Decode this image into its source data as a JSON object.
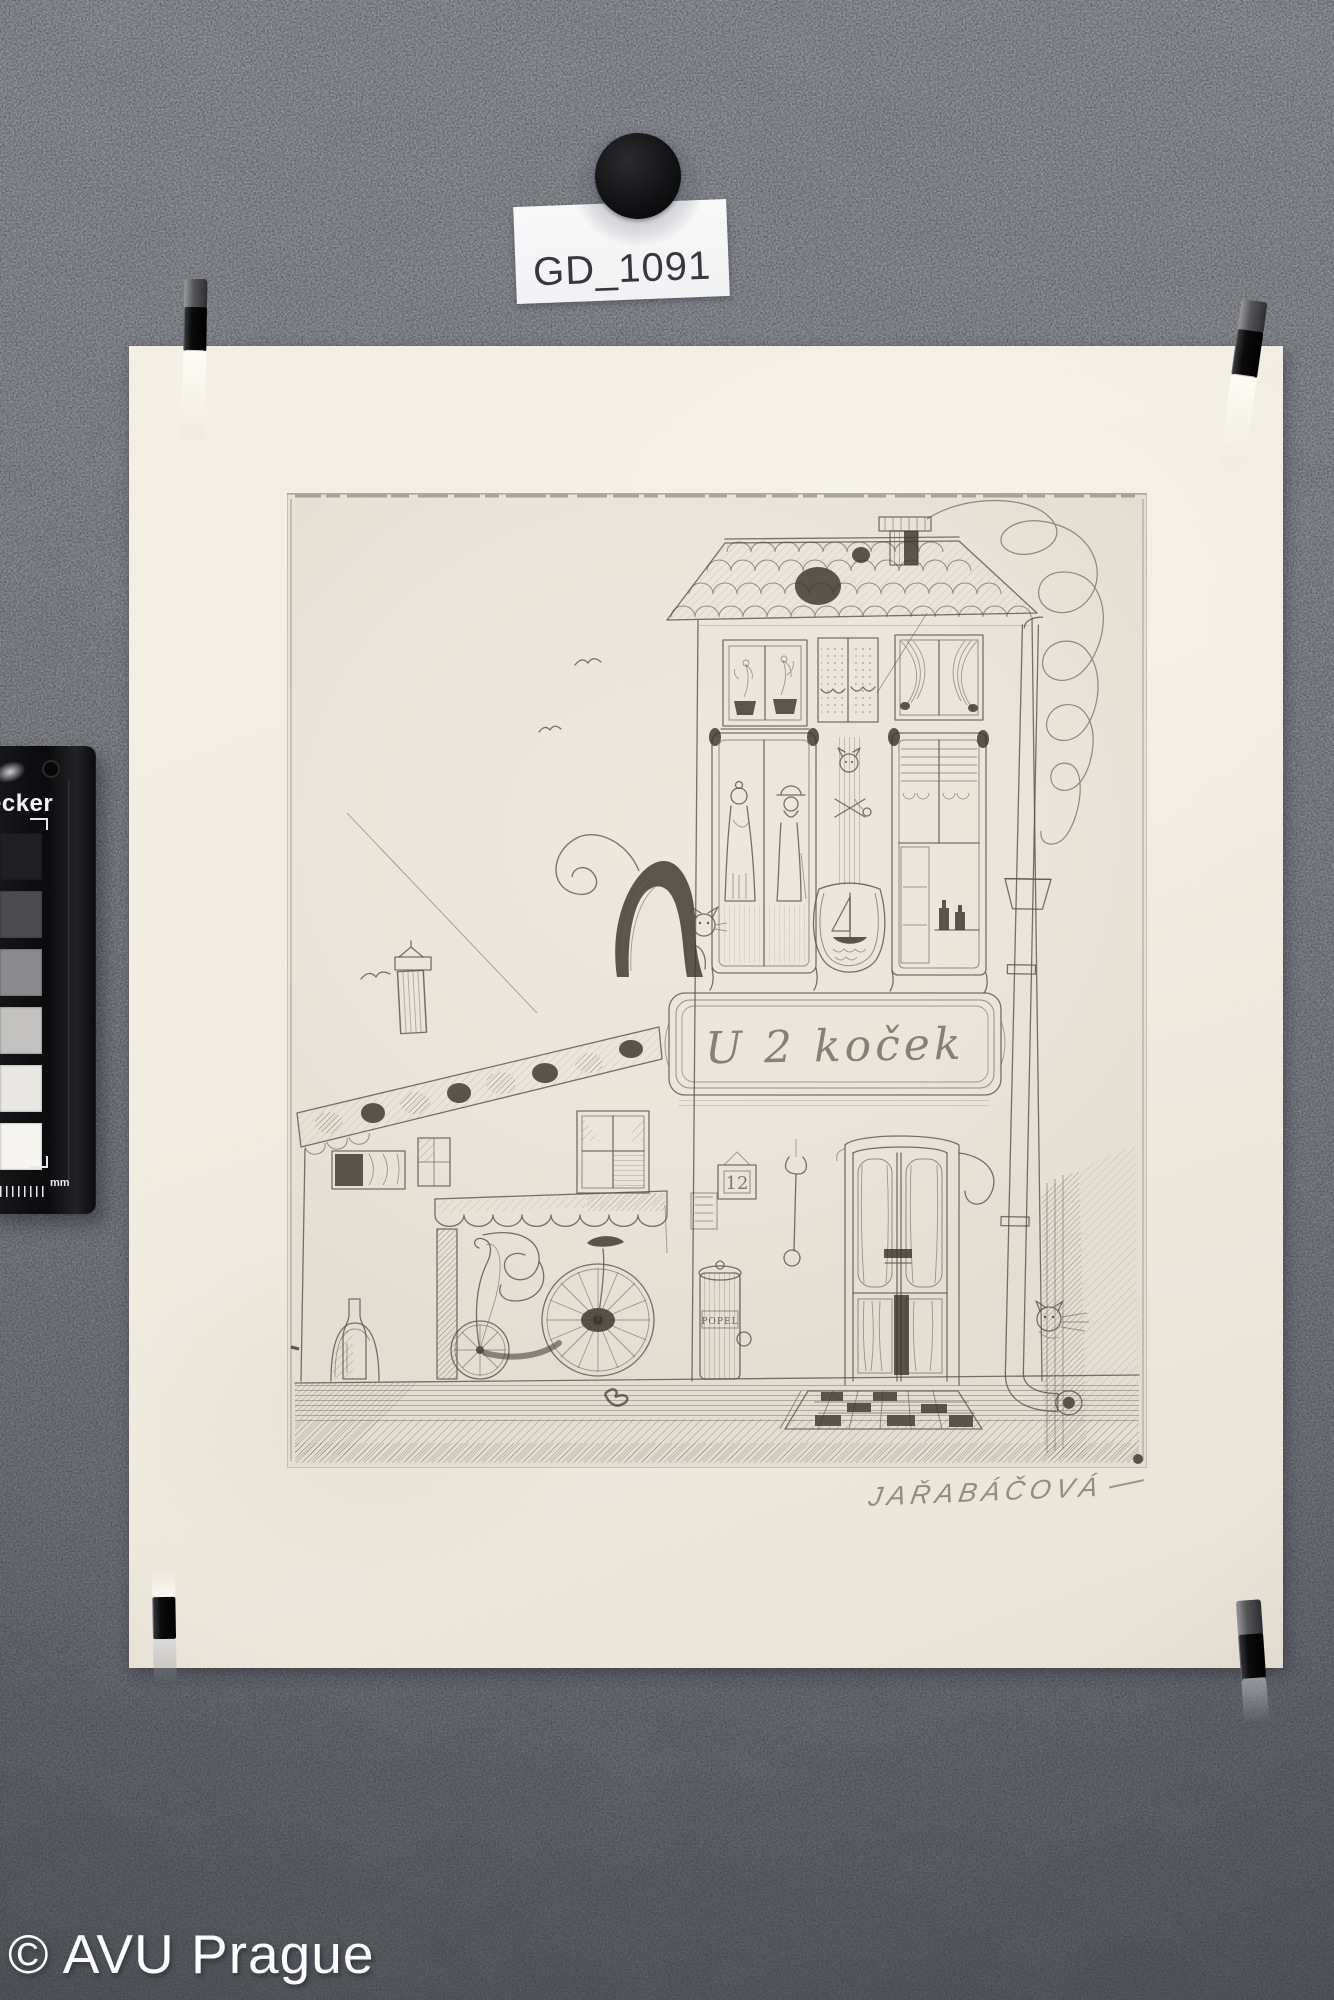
{
  "scene": {
    "wall_top_color": "#92969b",
    "wall_bottom_color": "#595d62",
    "paper_color": "#f1ece1",
    "plate_color": "#e9e5da"
  },
  "inventory_label": {
    "text": "GD_1091"
  },
  "artwork": {
    "sign_text": "U 2 koček",
    "house_number": "12",
    "barrel_label": "POPEL",
    "signature": "JAŘABÁČOVÁ"
  },
  "color_checker": {
    "visible_text": "ecker",
    "ruler_unit": "mm",
    "patches": [
      "#202022",
      "#4c4c4e",
      "#8b8b8d",
      "#c2c1bf",
      "#e9e7e4",
      "#f6f5f2"
    ]
  },
  "watermark": {
    "text": "© AVU Prague"
  }
}
